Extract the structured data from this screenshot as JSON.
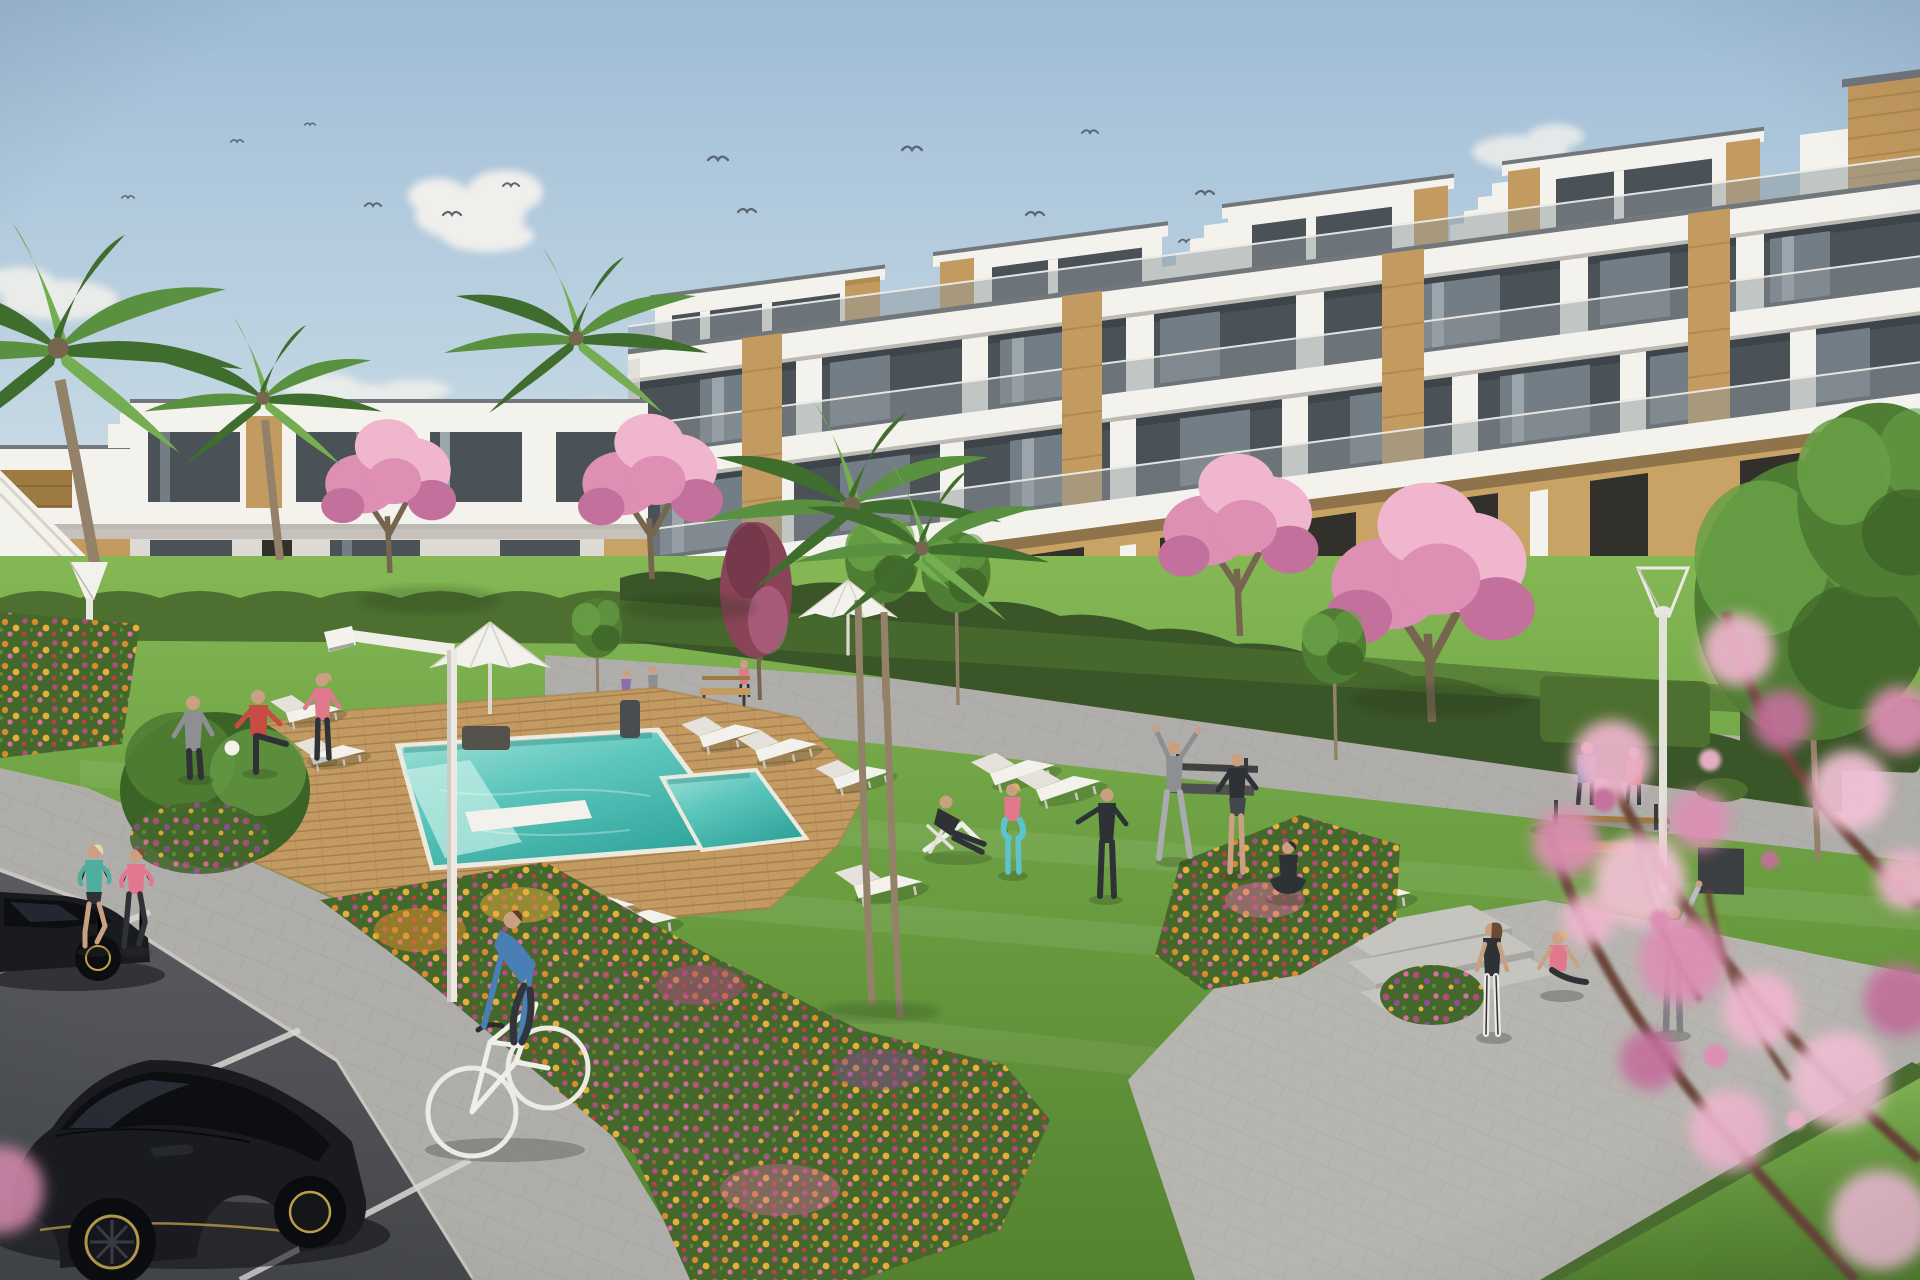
{
  "scene": {
    "kind": "architectural-exterior-render",
    "subject": "modern-apartment-complex-courtyard-with-pool"
  },
  "palette": {
    "sky_top": "#9fbcd6",
    "sky_mid": "#c3d7e3",
    "sky_low": "#e7edee",
    "cloud": "#f5f2ed",
    "bird": "#5a6671",
    "white_wall": "#f4f2ed",
    "white_shade": "#ddd9d3",
    "slab_shadow": "#bdb9b3",
    "coping": "#72777c",
    "glass_dark": "#4a5157",
    "glass_mid": "#737d85",
    "glass_light": "#9aa5ac",
    "balustrade": "#8d979c",
    "wood": "#c39a5f",
    "wood_dark": "#9e7a43",
    "wood_light": "#d9b98a",
    "ochre": "#c9a266",
    "opening": "#32302a",
    "hedge_dark": "#3a5527",
    "hedge_mid": "#4d7030",
    "hedge_light": "#5f8a3a",
    "lawn": "#6fa244",
    "lawn_light": "#85b855",
    "lawn_dark": "#54822f",
    "deck": "#c49a63",
    "deck_line": "#a37d4b",
    "pool_rim": "#eceadf",
    "water_light": "#a5e3d9",
    "water_mid": "#5cc6bc",
    "water_deep": "#2fa49b",
    "path": "#b0aeaa",
    "path_line": "#97958f",
    "plaza": "#b7b5b0",
    "step": "#c6c4be",
    "road": "#45474b",
    "road_hi": "#595b60",
    "road_line": "#d9d8d4",
    "curb": "#cfccc6",
    "car_black": "#1a1b1f",
    "car_hi": "#43464e",
    "car_glass": "#0d0e12",
    "car_glass_hi": "#3a414d",
    "gold": "#c2a14b",
    "trunk": "#94816a",
    "trunk_dark": "#77664f",
    "palm_dark": "#3f6d2e",
    "palm_mid": "#5a9140",
    "palm_light": "#74ad52",
    "blossom_light": "#efb6ce",
    "blossom_mid": "#dd8fb4",
    "blossom_deep": "#c4709c",
    "blossom_bokeh": "#f3c1d6",
    "redtree": "#8a4458",
    "redtree_dark": "#6e3346",
    "green_tree": "#4f7d33",
    "green_tree_light": "#69a047",
    "green_tree_dark": "#3c6326",
    "flower_orange": "#d88a2e",
    "flower_gold": "#e6ae3c",
    "flower_pink": "#d96f9f",
    "flower_magenta": "#b34a7f",
    "flower_purple": "#8e4d96",
    "flower_red": "#bb4040",
    "leaf": "#44672c",
    "skin": "#caa083",
    "teal_top": "#4fae9f",
    "pink_top": "#e2788e",
    "red_shirt": "#c84b44",
    "blue_shirt": "#4a7fb5",
    "gray_cloth": "#8d8f93",
    "dark_cloth": "#2e3135",
    "teal_leg": "#5fc3cf",
    "white_cloth": "#eceae6",
    "hoodie": "#b9bcc0",
    "purple_dress": "#8a6fae"
  },
  "birds": [
    {
      "x": 128,
      "y": 198,
      "s": 0.7
    },
    {
      "x": 237,
      "y": 142,
      "s": 0.7
    },
    {
      "x": 310,
      "y": 125,
      "s": 0.6
    },
    {
      "x": 373,
      "y": 206,
      "s": 0.9
    },
    {
      "x": 452,
      "y": 215,
      "s": 1.0
    },
    {
      "x": 511,
      "y": 186,
      "s": 0.9
    },
    {
      "x": 718,
      "y": 160,
      "s": 1.1
    },
    {
      "x": 747,
      "y": 212,
      "s": 1.0
    },
    {
      "x": 912,
      "y": 150,
      "s": 1.1
    },
    {
      "x": 1035,
      "y": 215,
      "s": 1.0
    },
    {
      "x": 1090,
      "y": 133,
      "s": 0.9
    },
    {
      "x": 1205,
      "y": 194,
      "s": 1.0
    },
    {
      "x": 1186,
      "y": 242,
      "s": 0.8
    }
  ],
  "inventory": {
    "buildings": 2,
    "pools": 2,
    "parasols": 2,
    "sun_loungers": 12,
    "benches": 3,
    "street_lamps": 3,
    "palm_trees": 5,
    "blossom_trees": 5,
    "green_trees": 5,
    "people": 20,
    "cars": 2,
    "bicycles": 1,
    "birds": 13,
    "flower_beds": 4
  }
}
